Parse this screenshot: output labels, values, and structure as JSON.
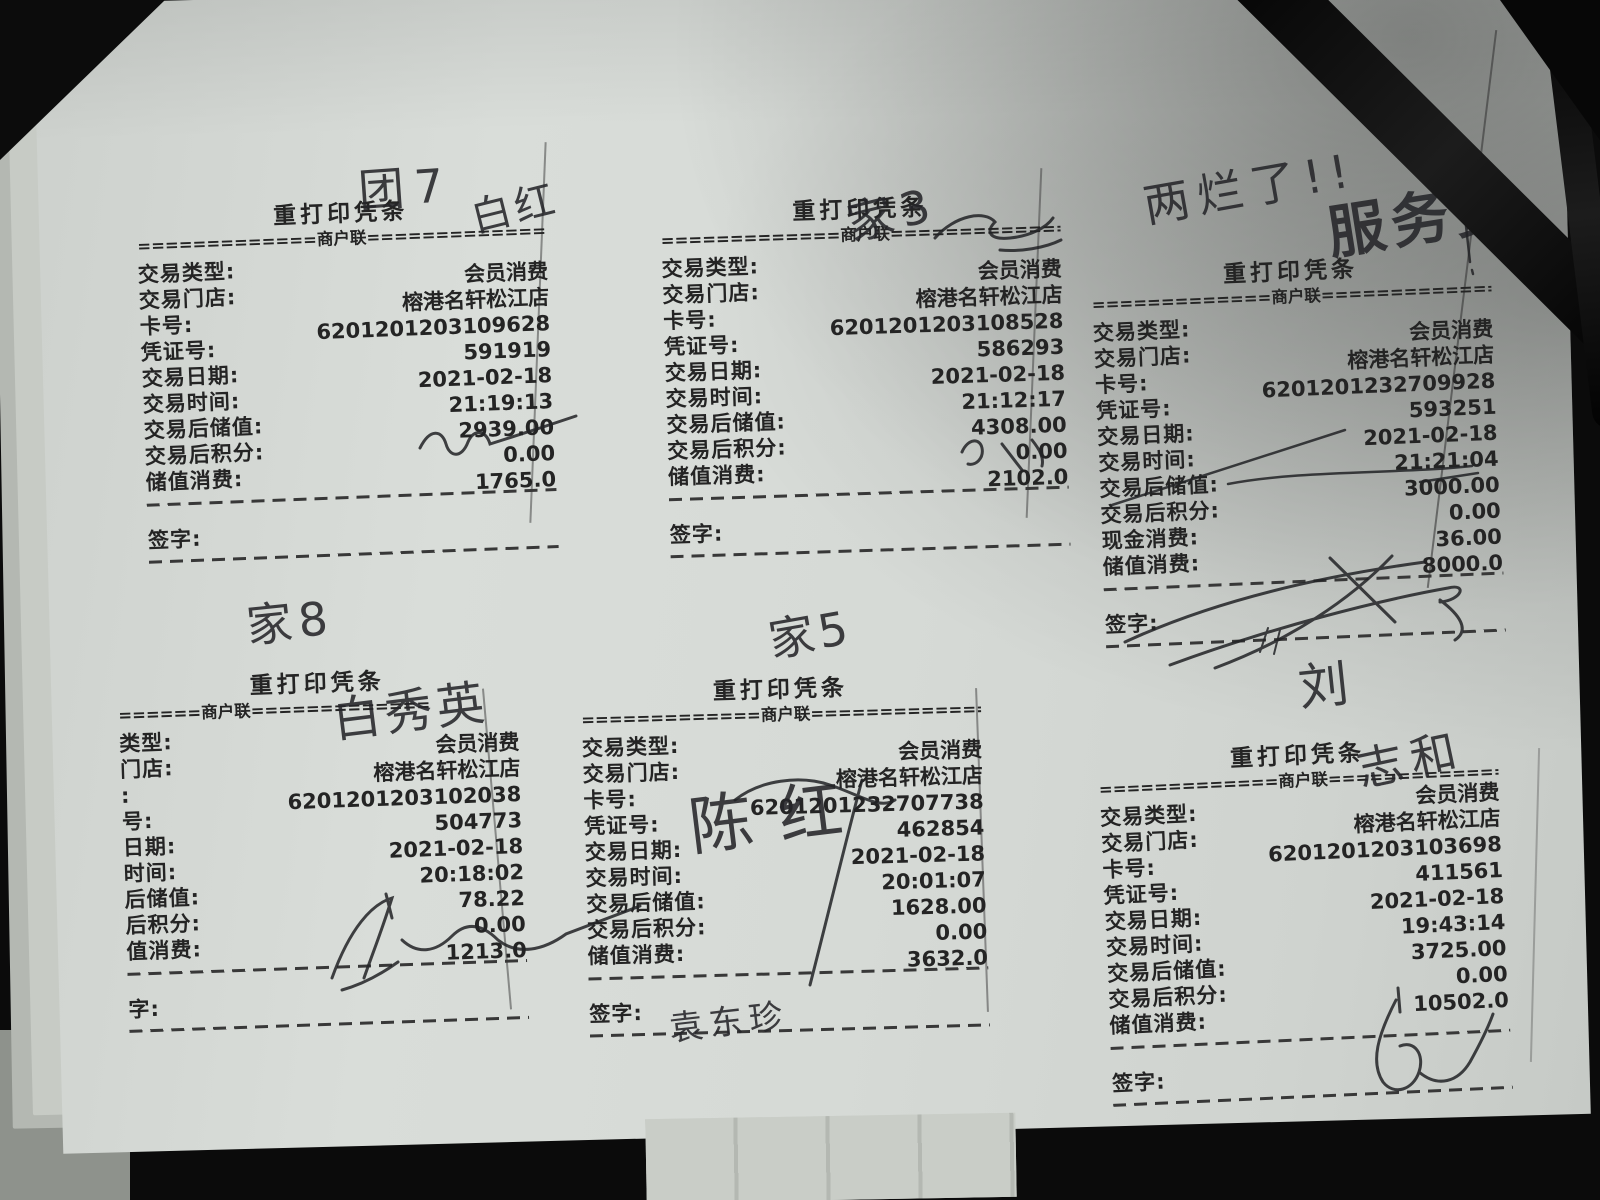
{
  "receipts": [
    {
      "title": "重打印凭条",
      "copy_line": "=============商户联=============",
      "rows": [
        {
          "label": "交易类型:",
          "value": "会员消费"
        },
        {
          "label": "交易门店:",
          "value": "榕港名轩松江店"
        },
        {
          "label": "卡号:",
          "value": "6201201203109628"
        },
        {
          "label": "凭证号:",
          "value": "591919"
        },
        {
          "label": "交易日期:",
          "value": "2021-02-18"
        },
        {
          "label": "交易时间:",
          "value": "21:19:13"
        },
        {
          "label": "交易后储值:",
          "value": "2939.00"
        },
        {
          "label": "交易后积分:",
          "value": "0.00"
        },
        {
          "label": "储值消费:",
          "value": "1765.0"
        }
      ],
      "sign_label": "签字:"
    },
    {
      "title": "重打印凭条",
      "copy_line": "=============商户联=============",
      "rows": [
        {
          "label": "交易类型:",
          "value": "会员消费"
        },
        {
          "label": "交易门店:",
          "value": "榕港名轩松江店"
        },
        {
          "label": "卡号:",
          "value": "6201201203108528"
        },
        {
          "label": "凭证号:",
          "value": "586293"
        },
        {
          "label": "交易日期:",
          "value": "2021-02-18"
        },
        {
          "label": "交易时间:",
          "value": "21:12:17"
        },
        {
          "label": "交易后储值:",
          "value": "4308.00"
        },
        {
          "label": "交易后积分:",
          "value": "0.00"
        },
        {
          "label": "储值消费:",
          "value": "2102.0"
        }
      ],
      "sign_label": "签字:"
    },
    {
      "title": "重打印凭条",
      "copy_line": "=============商户联=============",
      "rows": [
        {
          "label": "交易类型:",
          "value": "会员消费"
        },
        {
          "label": "交易门店:",
          "value": "榕港名轩松江店"
        },
        {
          "label": "卡号:",
          "value": "6201201232709928"
        },
        {
          "label": "凭证号:",
          "value": "593251"
        },
        {
          "label": "交易日期:",
          "value": "2021-02-18"
        },
        {
          "label": "交易时间:",
          "value": "21:21:04"
        },
        {
          "label": "交易后储值:",
          "value": "3000.00"
        },
        {
          "label": "交易后积分:",
          "value": "0.00"
        },
        {
          "label": "现金消费:",
          "value": "36.00"
        },
        {
          "label": "储值消费:",
          "value": "8000.0"
        }
      ],
      "sign_label": "签字:"
    },
    {
      "title": "重打印凭条",
      "copy_line": "======商户联=============",
      "rows": [
        {
          "label": "类型:",
          "value": "会员消费"
        },
        {
          "label": "门店:",
          "value": "榕港名轩松江店"
        },
        {
          "label": ":",
          "value": "6201201203102038"
        },
        {
          "label": "号:",
          "value": "504773"
        },
        {
          "label": "日期:",
          "value": "2021-02-18"
        },
        {
          "label": "时间:",
          "value": "20:18:02"
        },
        {
          "label": "后储值:",
          "value": "78.22"
        },
        {
          "label": "后积分:",
          "value": "0.00"
        },
        {
          "label": "值消费:",
          "value": "1213.0"
        }
      ],
      "sign_label": "字:"
    },
    {
      "title": "重打印凭条",
      "copy_line": "=============商户联=============",
      "rows": [
        {
          "label": "交易类型:",
          "value": "会员消费"
        },
        {
          "label": "交易门店:",
          "value": "榕港名轩松江店"
        },
        {
          "label": "卡号:",
          "value": "6201201232707738"
        },
        {
          "label": "凭证号:",
          "value": "462854"
        },
        {
          "label": "交易日期:",
          "value": "2021-02-18"
        },
        {
          "label": "交易时间:",
          "value": "20:01:07"
        },
        {
          "label": "交易后储值:",
          "value": "1628.00"
        },
        {
          "label": "交易后积分:",
          "value": "0.00"
        },
        {
          "label": "储值消费:",
          "value": "3632.0"
        }
      ],
      "sign_label": "签字:"
    },
    {
      "title": "重打印凭条",
      "copy_line": "=============商户联=============",
      "rows": [
        {
          "label": "交易类型:",
          "value": "会员消费"
        },
        {
          "label": "交易门店:",
          "value": "榕港名轩松江店"
        },
        {
          "label": "卡号:",
          "value": "6201201203103698"
        },
        {
          "label": "凭证号:",
          "value": "411561"
        },
        {
          "label": "交易日期:",
          "value": "2021-02-18"
        },
        {
          "label": "交易时间:",
          "value": "19:43:14"
        },
        {
          "label": "交易后储值:",
          "value": "3725.00"
        },
        {
          "label": "交易后积分:",
          "value": "0.00"
        },
        {
          "label": "储值消费:",
          "value": "10502.0"
        }
      ],
      "sign_label": "签字:"
    }
  ],
  "annotations": {
    "r1_table": "团7",
    "r1_name": "白红",
    "r2_table": "家3",
    "corner_note": "两烂了!!",
    "corner_name": "服务费",
    "r4_table": "家8",
    "r4_name": "白秀英",
    "r5_table": "家5",
    "r5_name": "陈红",
    "r5_sign": "袁东珍",
    "r6_surname": "刘",
    "r6_name": "志和"
  }
}
